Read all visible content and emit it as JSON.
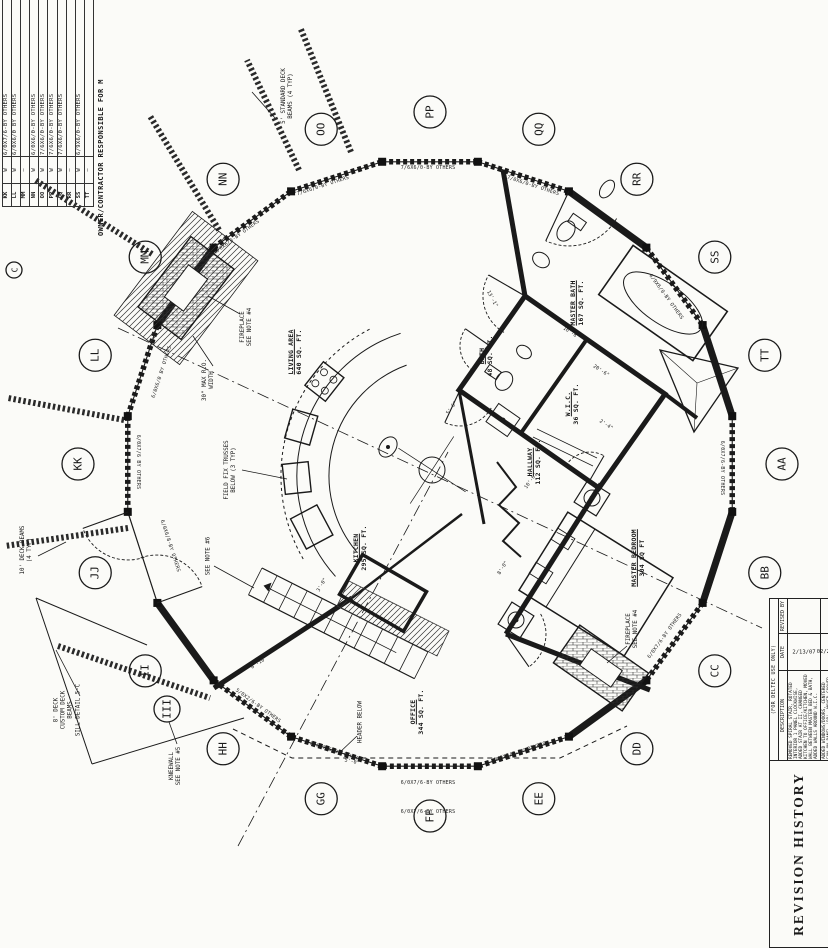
{
  "sheet": {
    "side_note": "OWNER/CONTRACTOR RESPONSIBLE FOR M",
    "schedule": {
      "rows": [
        {
          "mark": "KK",
          "qty": "W",
          "size": "6/0X7/6-BY OTHERS"
        },
        {
          "mark": "LL",
          "qty": "W",
          "size": "6/0X6/0 BY OTHERS"
        },
        {
          "mark": "MM",
          "qty": "—",
          "size": ""
        },
        {
          "mark": "NN",
          "qty": "W",
          "size": "6/0X6/0-BY OTHERS"
        },
        {
          "mark": "OO",
          "qty": "W",
          "size": "7/6X6/0-BY OTHERS"
        },
        {
          "mark": "PP",
          "qty": "W",
          "size": "7/6X6/0-BY OTHERS"
        },
        {
          "mark": "QQ",
          "qty": "W",
          "size": "7/6X6/0-BY OTHERS"
        },
        {
          "mark": "RR",
          "qty": "—",
          "size": ""
        },
        {
          "mark": "SS",
          "qty": "W",
          "size": "6/9X6/0-BY OTHERS"
        },
        {
          "mark": "TT",
          "qty": "—",
          "size": ""
        }
      ]
    },
    "revision_history": {
      "title": "REVISION HISTORY",
      "subtitle": "(FOR DELTEC USE ONLY)",
      "columns": {
        "description": "DESCRIPTION",
        "date": "DATE",
        "revised_by": "REVISED BY"
      },
      "rows": [
        {
          "description": "REMOVED SPIRAL STAIR, ROTATED INTERIOR 1 PANEL CLOCKWISE, ADDED STAIR AT II, CHANGED KITCHEN TO OFFICE/KITCHEN, MOVED WALL BETWEEN MASTER BED & BATH, ADDED WALLS AROUND W.I.C.",
          "date": "2/13/07",
          "revised_by": ""
        },
        {
          "description": "ADDED WINDOWS/DOORS, CENTERED FAN ON PANEL 'BB', MOVED SHOWER IN MASTER BATH TO PANEL",
          "date": "02/23/07",
          "revised_by": ""
        }
      ]
    }
  },
  "plan": {
    "panel_markers": [
      {
        "letter": "PP",
        "angle": -90
      },
      {
        "letter": "QQ",
        "angle": -72
      },
      {
        "letter": "RR",
        "angle": -54
      },
      {
        "letter": "SS",
        "angle": -36
      },
      {
        "letter": "TT",
        "angle": -18
      },
      {
        "letter": "AA",
        "angle": 0
      },
      {
        "letter": "BB",
        "angle": 18
      },
      {
        "letter": "CC",
        "angle": 36
      },
      {
        "letter": "DD",
        "angle": 54
      },
      {
        "letter": "EE",
        "angle": 72
      },
      {
        "letter": "FF",
        "angle": 90
      },
      {
        "letter": "GG",
        "angle": 108
      },
      {
        "letter": "HH",
        "angle": 126
      },
      {
        "letter": "II",
        "angle": 144
      },
      {
        "letter": "JJ",
        "angle": 162
      },
      {
        "letter": "KK",
        "angle": 180
      },
      {
        "letter": "LL",
        "angle": 198
      },
      {
        "letter": "MM",
        "angle": 216
      },
      {
        "letter": "NN",
        "angle": 234
      },
      {
        "letter": "OO",
        "angle": 252
      }
    ],
    "extra_markers": [
      {
        "letter": "III",
        "x": 167,
        "y": 709,
        "r": 13
      },
      {
        "letter": "C",
        "x": 14,
        "y": 270,
        "r": 8
      }
    ],
    "room_labels": [
      {
        "name": "living-area",
        "title": "LIVING AREA",
        "sub": "640 SQ. FT.",
        "x": 295,
        "y": 352
      },
      {
        "name": "kitchen",
        "title": "KITCHEN",
        "sub": "295 SQ. FT.",
        "x": 360,
        "y": 548
      },
      {
        "name": "bath",
        "title": "BATH",
        "sub": "48 SQ. FT.",
        "x": 486,
        "y": 356
      },
      {
        "name": "wic",
        "title": "W.I.C.",
        "sub": "36 SQ. FT.",
        "x": 572,
        "y": 404
      },
      {
        "name": "master-bath",
        "title": "MASTER BATH",
        "sub": "167 SQ. FT.",
        "x": 577,
        "y": 303
      },
      {
        "name": "master-bedroom",
        "title": "MASTER BEDROOM",
        "sub": "304 SQ FT",
        "x": 638,
        "y": 558
      },
      {
        "name": "hallway",
        "title": "HALLWAY",
        "sub": "112 SQ. FT.",
        "x": 534,
        "y": 462
      },
      {
        "name": "office",
        "title": "OFFICE",
        "sub": "344 SQ. FT.",
        "x": 417,
        "y": 712
      }
    ],
    "note_labels": [
      {
        "name": "deck-beams-5ft",
        "text": "5' STANDARD DECK\nBEAMS (4 TYP)",
        "x": 288,
        "y": 96
      },
      {
        "name": "deck-beams-10ft",
        "text": "10' DECK BEAMS\n(4 TYP)",
        "x": 27,
        "y": 550
      },
      {
        "name": "custom-deck",
        "text": "8' DECK\nCUSTOM DECK\nBEAMS\nSILL DETAIL 5-C",
        "x": 68,
        "y": 710
      },
      {
        "name": "kneewall",
        "text": "KNEEWALL\nSEE NOTE #5",
        "x": 176,
        "y": 766
      },
      {
        "name": "see-note-6",
        "text": "SEE NOTE #6",
        "x": 209,
        "y": 556
      },
      {
        "name": "fireplace-note-upper-left",
        "text": "FIREPLACE\nSEE NOTE #4",
        "x": 247,
        "y": 327
      },
      {
        "name": "max-ro-width",
        "text": "30\" MAX R.O.\nWIDTH",
        "x": 209,
        "y": 380
      },
      {
        "name": "field-fix-trusses",
        "text": "FIELD FIX TRUSSES\nBELOW (3 TYP)",
        "x": 231,
        "y": 470
      },
      {
        "name": "header-below",
        "text": "HEADER BELOW",
        "x": 361,
        "y": 722
      },
      {
        "name": "fireplace-note-bottom-right",
        "text": "FIREPLACE\nSEE NOTE #4",
        "x": 633,
        "y": 629
      }
    ],
    "wall_labels": [
      {
        "text": "7/6X6/0-BY OTHERS",
        "x": 428,
        "y": 168,
        "rot": 0
      },
      {
        "text": "7/0X6/0-BY OTHERS",
        "x": 533,
        "y": 186,
        "rot": 18
      },
      {
        "text": "7/6X6/0-BY OTHERS",
        "x": 323,
        "y": 186,
        "rot": -18
      },
      {
        "text": "6/0X6/0-BY OTHERS",
        "x": 237,
        "y": 237,
        "rot": -36
      },
      {
        "text": "6/9X6/0-BY OTHERS",
        "x": 666,
        "y": 297,
        "rot": 54
      },
      {
        "text": "6/0X7/6-BY OTHERS",
        "x": 722,
        "y": 468,
        "rot": 90
      },
      {
        "text": "6/0X7/6 BY OTHERS",
        "x": 138,
        "y": 462,
        "rot": 90
      },
      {
        "text": "6/0X6/0 BY OTHERS",
        "x": 162,
        "y": 372,
        "rot": -72
      },
      {
        "text": "6/0X7/6-BY OTHERS",
        "x": 665,
        "y": 636,
        "rot": -54
      },
      {
        "text": "6/0X7/6-BY OTHERS",
        "x": 520,
        "y": 752,
        "rot": -18
      },
      {
        "text": "6/0X7/6-BY OTHERS",
        "x": 428,
        "y": 783,
        "rot": 0
      },
      {
        "text": "6/0X7/6-BY OTHERS",
        "x": 428,
        "y": 812,
        "rot": 0
      },
      {
        "text": "6/0X7/6-BY OTHERS",
        "x": 336,
        "y": 752,
        "rot": 18
      },
      {
        "text": "5/0X2/6-BY OTHERS",
        "x": 258,
        "y": 706,
        "rot": 36
      },
      {
        "text": "6/0X6/8-BY OTHERS",
        "x": 170,
        "y": 546,
        "rot": 72
      }
    ],
    "dim_labels": [
      {
        "text": "8'-0\"",
        "x": 503,
        "y": 568,
        "rot": -58
      },
      {
        "text": "8'-10\"",
        "x": 259,
        "y": 663,
        "rot": -33
      },
      {
        "text": "5'-6\"",
        "x": 452,
        "y": 408,
        "rot": -55
      },
      {
        "text": "13'-1\"",
        "x": 492,
        "y": 299,
        "rot": 62
      },
      {
        "text": "20'-6\"",
        "x": 601,
        "y": 371,
        "rot": 33
      },
      {
        "text": "10'-6\"",
        "x": 531,
        "y": 481,
        "rot": -55
      },
      {
        "text": "3'-0\"",
        "x": 322,
        "y": 585,
        "rot": -60
      },
      {
        "text": "5'-0\"",
        "x": 352,
        "y": 762,
        "rot": 12
      },
      {
        "text": "2'-4\"",
        "x": 606,
        "y": 425,
        "rot": 33
      },
      {
        "text": "16'-8\"",
        "x": 571,
        "y": 333,
        "rot": 33
      }
    ]
  }
}
